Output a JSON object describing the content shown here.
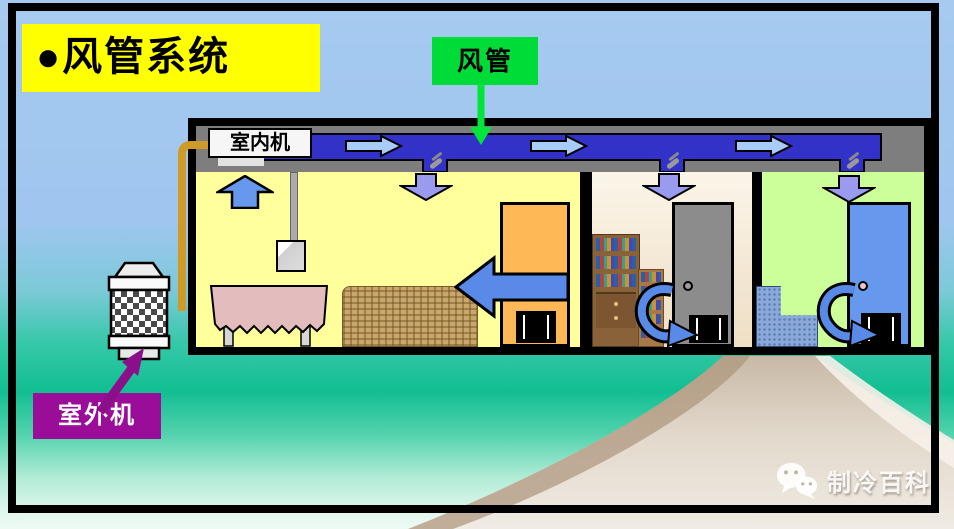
{
  "slide": {
    "title": "●风管系统",
    "title_bg": "#FFFF00",
    "background_top_color": "#A6CAF0",
    "background_mid_color": "#12BE92",
    "background_bottom_color": "#EDFAF4"
  },
  "callouts": {
    "duct_label": "风管",
    "duct_label_bg": "#00DC37",
    "indoor_unit_label": "室内机",
    "outdoor_unit_label": "室外机",
    "outdoor_label_bg": "#990D99"
  },
  "diagram": {
    "duct_color": "#3232C8",
    "refrigerant_pipe_color": "#CF9A28",
    "airflow_arrows_in_duct": 3,
    "duct_outlets": 3,
    "rooms": [
      {
        "name": "living room",
        "wall_color": "#FFFF9C",
        "furniture": [
          "dining table",
          "sofa",
          "cabinet with TV"
        ],
        "airflow": [
          "return-air-up-arrow",
          "supply-air-down-arrow",
          "cross-room-left-arrow"
        ]
      },
      {
        "name": "study",
        "wall_color": "#F7EEDC",
        "furniture": [
          "large bookshelf",
          "small bookshelf",
          "gray door with grille"
        ],
        "airflow": [
          "supply-air-down-arrow",
          "door-return-curved-arrow"
        ]
      },
      {
        "name": "bedroom",
        "wall_color": "#CCFF99",
        "furniture": [
          "armchair",
          "blue door with grille"
        ],
        "airflow": [
          "supply-air-down-arrow",
          "door-return-curved-arrow"
        ]
      }
    ]
  },
  "watermark": {
    "text": "制冷百科",
    "icon": "wechat-icon"
  }
}
